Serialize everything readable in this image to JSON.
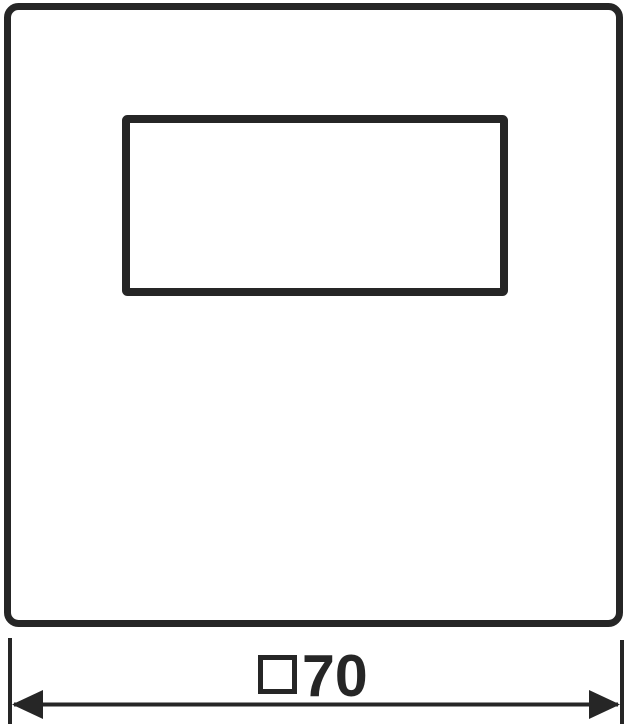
{
  "drawing": {
    "kind": "technical-dimension-drawing",
    "background_color": "#ffffff",
    "line_color": "#262626"
  },
  "shapes": {
    "outer_plate": "rounded-square-outline",
    "window_cutout": "rectangle-outline"
  },
  "dimension": {
    "symbol": "□",
    "value": "70",
    "label": "□70",
    "arrow_left": "filled-triangle-left",
    "arrow_right": "filled-triangle-right"
  }
}
